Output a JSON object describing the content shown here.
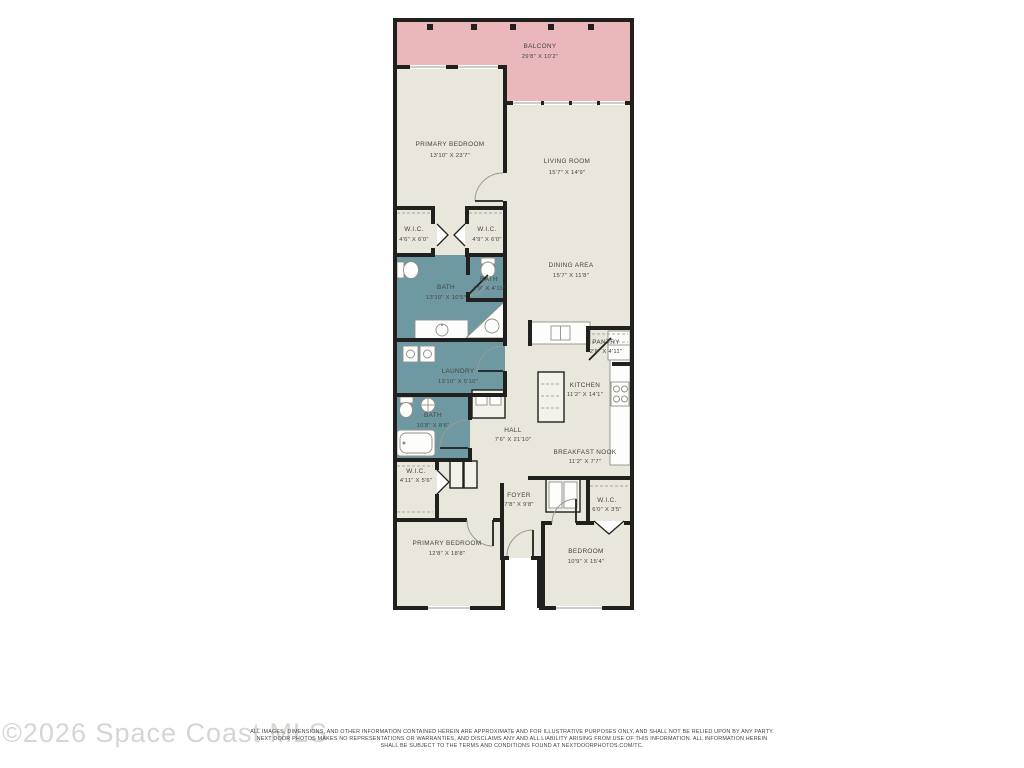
{
  "watermark": "©2026 Space Coast MLS",
  "disclaimer": {
    "line1": "ALL IMAGES, DIMENSIONS, AND OTHER INFORMATION CONTAINED HEREIN ARE APPROXIMATE AND FOR ILLUSTRATIVE PURPOSES ONLY, AND SHALL NOT BE RELIED UPON BY ANY PARTY.",
    "line2": "NEXT DOOR PHOTOS MAKES NO REPRESENTATIONS OR WARRANTIES, AND DISCLAIMS ANY AND ALL LIABILITY ARISING FROM USE OF THIS INFORMATION. ALL INFORMATION HEREIN",
    "line3": "SHALL BE SUBJECT TO THE TERMS AND CONDITIONS FOUND AT NEXTDOORPHOTOS.COM/TC."
  },
  "colors": {
    "wall": "#20201e",
    "floor_cream": "#e9e7db",
    "wet_room_teal": "#6f99a2",
    "balcony_pink": "#eab7bb",
    "label_text": "#45443f",
    "watermark_gray": "#d7d5d2"
  },
  "rooms": {
    "balcony": {
      "name": "BALCONY",
      "dims": "29'8\" X 10'2\""
    },
    "primary_bedroom_1": {
      "name": "PRIMARY BEDROOM",
      "dims": "13'10\" X 23'7\""
    },
    "living_room": {
      "name": "LIVING ROOM",
      "dims": "15'7\" X 14'9\""
    },
    "wic_1": {
      "name": "W.I.C.",
      "dims": "4'6\" X 6'0\""
    },
    "wic_2": {
      "name": "W.I.C.",
      "dims": "4'9\" X 6'0\""
    },
    "bath_primary": {
      "name": "BATH",
      "dims": "13'10\" X 10'5\""
    },
    "bath_small": {
      "name": "BATH",
      "dims": "4'9\" X 4'11\""
    },
    "dining_area": {
      "name": "DINING AREA",
      "dims": "15'7\" X 11'8\""
    },
    "laundry": {
      "name": "LAUNDRY",
      "dims": "13'10\" X 5'10\""
    },
    "pantry": {
      "name": "PANTRY",
      "dims": "2'6\" X 4'11\""
    },
    "kitchen": {
      "name": "KITCHEN",
      "dims": "11'2\" X 14'1\""
    },
    "bath_hall": {
      "name": "BATH",
      "dims": "10'8\" X 8'6\""
    },
    "hall": {
      "name": "HALL",
      "dims": "7'6\" X 21'10\""
    },
    "breakfast_nook": {
      "name": "BREAKFAST NOOK",
      "dims": "11'2\" X 7'7\""
    },
    "wic_3": {
      "name": "W.I.C.",
      "dims": "4'11\" X 5'6\""
    },
    "foyer": {
      "name": "FOYER",
      "dims": "7'8\" X 9'8\""
    },
    "wic_4": {
      "name": "W.I.C.",
      "dims": "6'0\" X 3'5\""
    },
    "primary_bedroom_2": {
      "name": "PRIMARY BEDROOM",
      "dims": "12'8\" X 18'8\""
    },
    "bedroom": {
      "name": "BEDROOM",
      "dims": "10'9\" X 15'4\""
    }
  }
}
